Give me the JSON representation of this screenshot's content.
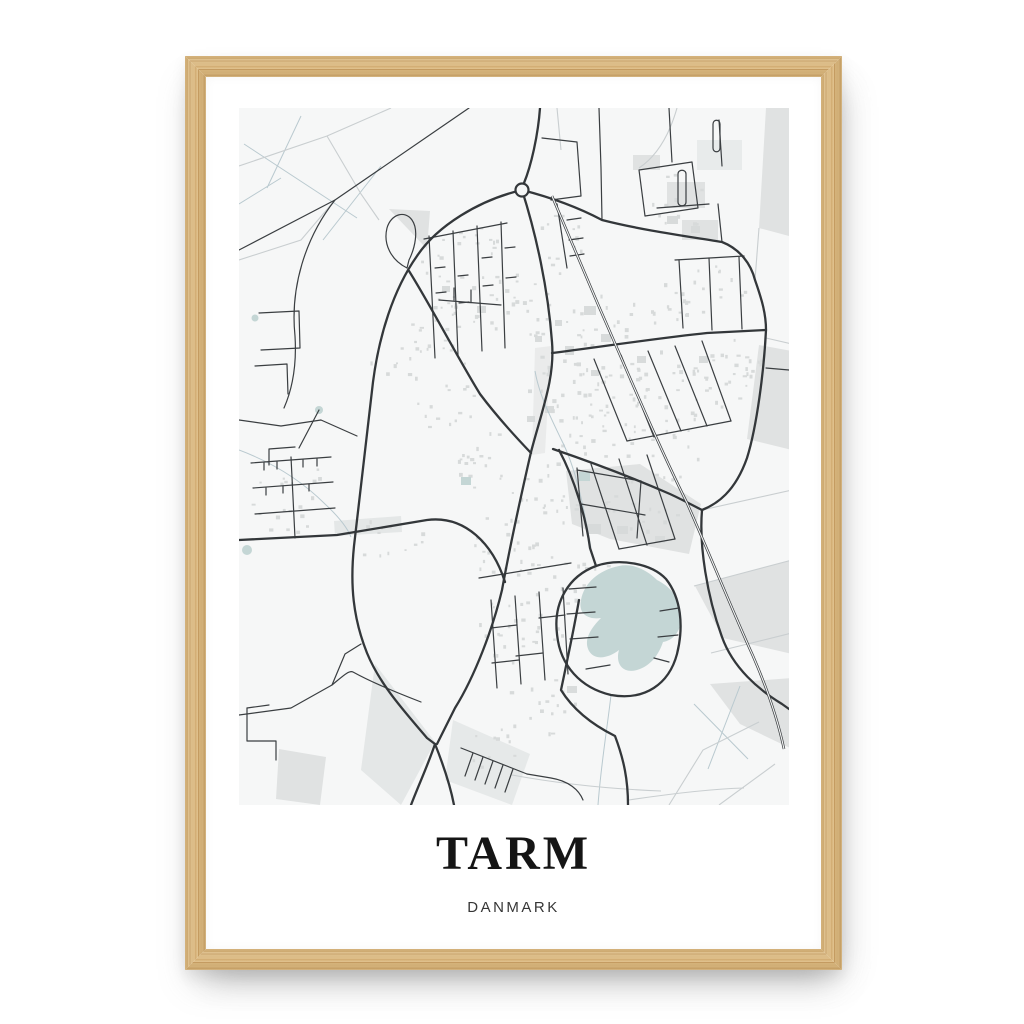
{
  "poster": {
    "title": "TARM",
    "subtitle": "DANMARK"
  },
  "colors": {
    "page_bg": "#ffffff",
    "poster_bg": "#ffffff",
    "frame_wood": "#dcba82",
    "frame_grain": "#c79e63",
    "map_bg": "#f6f7f7",
    "road_major": "#33373a",
    "road_minor": "#3a3e41",
    "road_rural": "#c9ced0",
    "path_pale": "#b9c9cf",
    "railway": "#3d4144",
    "water": "#c4d6d5",
    "area_gray": "#e0e2e2",
    "building_gray": "#d7dada"
  }
}
